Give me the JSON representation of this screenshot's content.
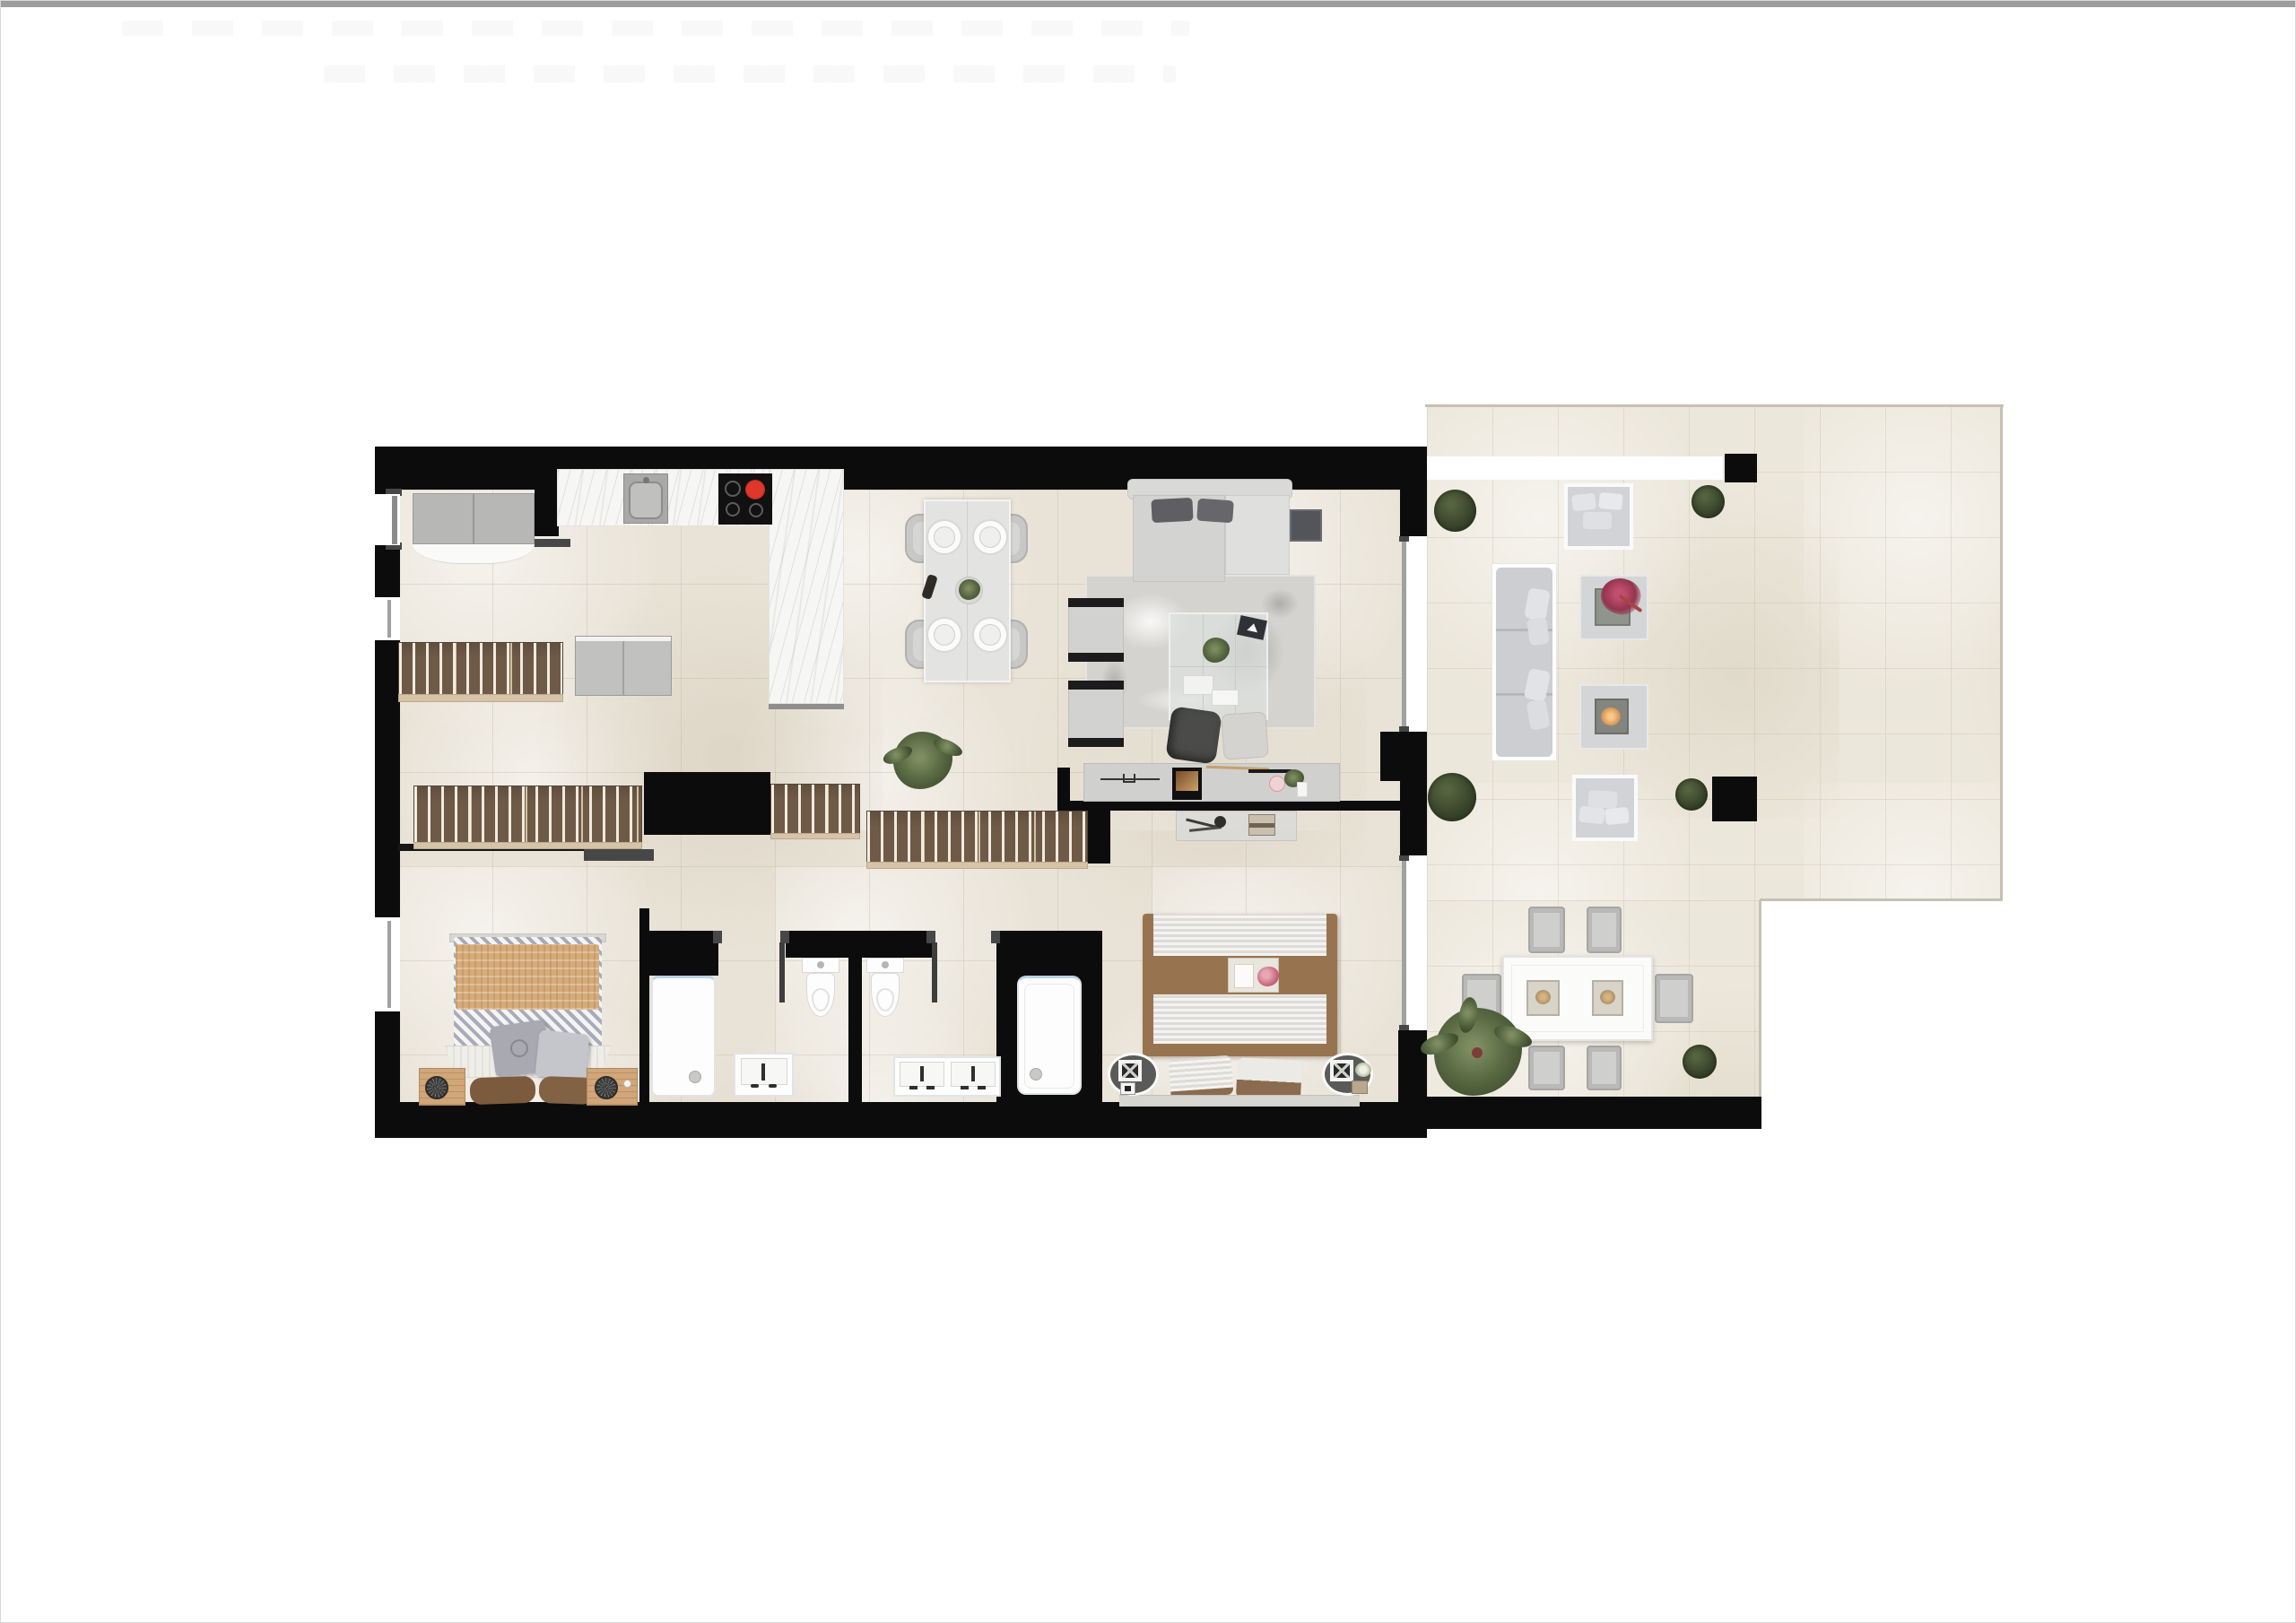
{
  "document": {
    "kind": "apartment-floor-plan-render",
    "view": "top-down 2D render, no text labels",
    "top_bar_color": "#9d9d9d",
    "page_background": "#ffffff"
  },
  "palette": {
    "wall": "#0c0c0c",
    "floor": "#e9e3d7",
    "terrace_floor": "#ece7db",
    "page_bg": "#ffffff",
    "marble": "#f6f6f4",
    "wood_wardrobe": "#6f5a47",
    "wood_light": "#d6c3a8",
    "nightstand_wood": "#d1a678",
    "gray_furniture": "#d6d6d4",
    "dark_pillow": "#5f5f63",
    "tan_blanket": "#d7ab78",
    "bed_brown": "#97744f",
    "fixture_white": "#fdfdfd",
    "cooktop_black": "#111111",
    "burner_red": "#e0372b",
    "plant_green": "#46543a",
    "flower_magenta": "#b03a5a",
    "fire_glow": "#e8a05a",
    "glass_door": "#9fa1a2"
  },
  "rooms": [
    {
      "name": "entry-hall",
      "furniture": [
        "entry-door",
        "tall-cabinet",
        "sliding-slat-wardrobe",
        "two-door-cabinet"
      ]
    },
    {
      "name": "kitchen",
      "furniture": [
        "counter-marble",
        "sink",
        "induction-cooktop-red-burner",
        "marble-island"
      ]
    },
    {
      "name": "dining-area",
      "furniture": [
        "dining-table",
        "4-chairs",
        "4-place-settings",
        "wine-bottle",
        "centerpiece-plant"
      ]
    },
    {
      "name": "living-room",
      "furniture": [
        "l-shaped-sofa",
        "2-dark-pillows",
        "side-table",
        "shag-rug",
        "glass-coffee-table",
        "2-armchairs",
        "dark-pouf",
        "light-pouf",
        "tv-sideboard",
        "potted-fern"
      ]
    },
    {
      "name": "hallway",
      "furniture": [
        "slat-wardrobe-a",
        "slat-wardrobe-b",
        "slat-wardrobe-c",
        "open-door-leaf"
      ]
    },
    {
      "name": "bedroom-1",
      "furniture": [
        "double-bed-tan-knit-throw",
        "zigzag-bedding",
        "foot-bench",
        "2-gray-pillows",
        "2-brown-cushions",
        "2-wood-nightstands",
        "2-fan-decor",
        "window"
      ]
    },
    {
      "name": "bathroom-1",
      "furniture": [
        "shower-tray",
        "vanity-sink",
        "toilet",
        "door-leaf"
      ]
    },
    {
      "name": "bathroom-2",
      "furniture": [
        "toilet",
        "double-vanity",
        "bathtub-in-niche",
        "door-leaf"
      ]
    },
    {
      "name": "master-bedroom",
      "furniture": [
        "king-bed-brown-runner",
        "breakfast-tray-flowers",
        "2-pillows",
        "2-oval-rugs-with-decor",
        "glass-bench",
        "sliding-glass-door"
      ]
    },
    {
      "name": "terrace-lounge",
      "furniture": [
        "outdoor-sofa",
        "2-outdoor-armchairs",
        "side-table-magenta-flowers",
        "fire-pit-table",
        "4-box-hedges",
        "white-planter-band",
        "2-pillars"
      ]
    },
    {
      "name": "terrace-dining",
      "furniture": [
        "outdoor-table",
        "2-lanterns",
        "6-outdoor-chairs",
        "large-potted-plant",
        "box-hedge"
      ]
    }
  ]
}
